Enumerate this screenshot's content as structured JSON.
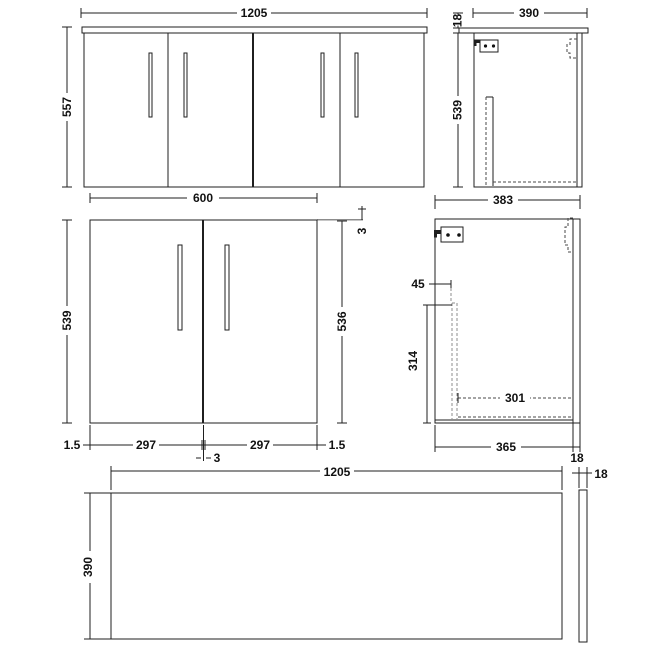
{
  "page": {
    "background": "#ffffff",
    "line_color": "#1f1f1f",
    "gray_line_color": "#8c8c8c",
    "dashed_line_color": "#4a4a4a",
    "text_color": "#111111"
  },
  "views": {
    "front_full": {
      "label": "front-view-full-unit",
      "width": "1205",
      "height": "557"
    },
    "side_full": {
      "label": "side-view-with-worktop",
      "depth": "390",
      "worktop_thickness": "18",
      "height": "539"
    },
    "front_single": {
      "label": "front-view-single-cabinet",
      "width": "600",
      "height": "539",
      "door_height": "536",
      "top_gap": "3",
      "left_margin": "1.5",
      "door_width_left": "297",
      "door_width_right": "297",
      "right_margin": "1.5",
      "center_gap": "3"
    },
    "side_detail": {
      "label": "side-view-cabinet-interior",
      "depth": "383",
      "back_panel_offset": "45",
      "back_panel_height": "314",
      "shelf_depth": "301",
      "carcass_depth": "365",
      "door_thickness": "18"
    },
    "plan": {
      "label": "plan-view-worktop",
      "width": "1205",
      "depth": "390",
      "thickness": "18"
    }
  }
}
